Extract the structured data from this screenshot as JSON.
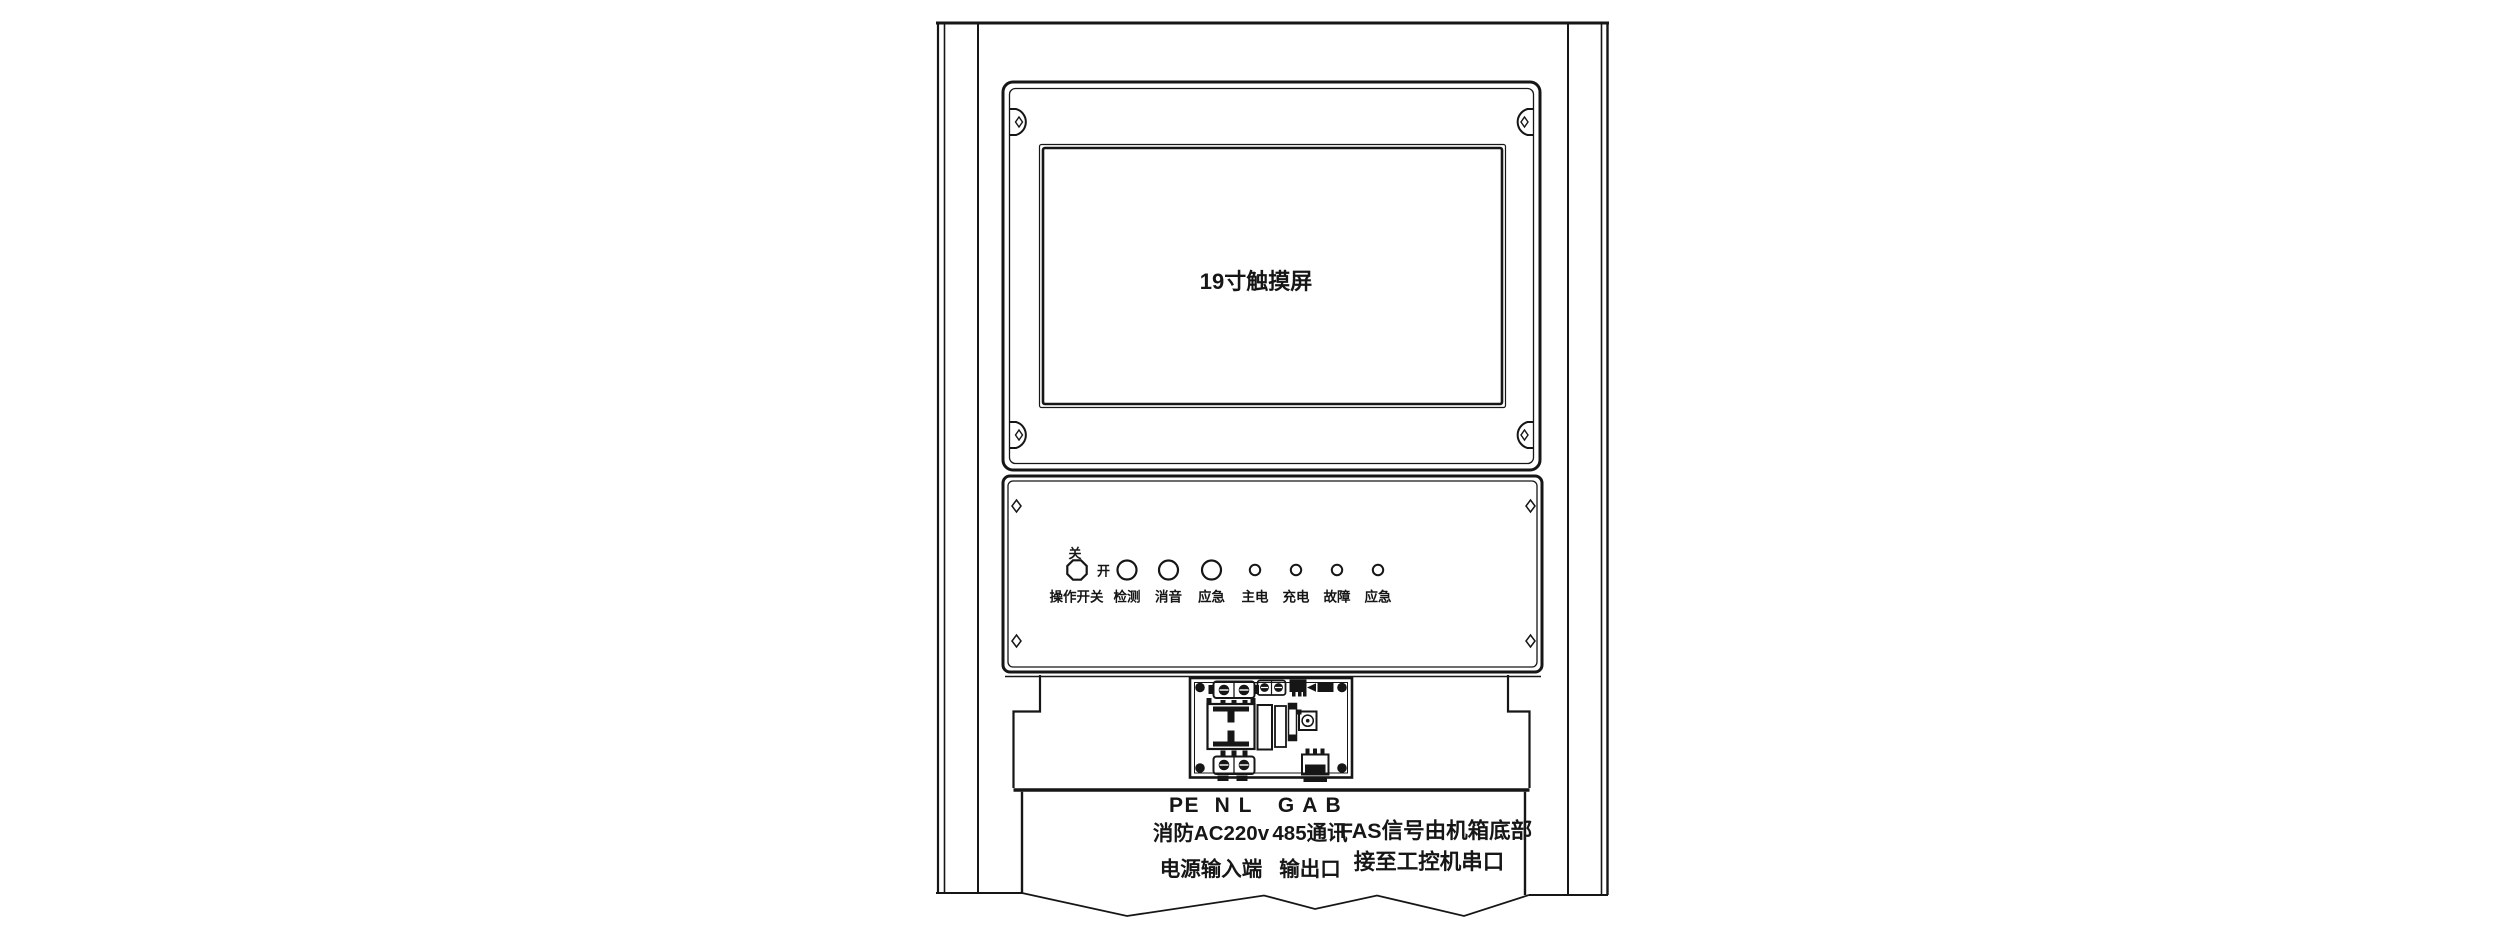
{
  "diagram": {
    "screen_label": "19寸触摸屏",
    "panel": {
      "switch_off": "关",
      "switch_on": "开",
      "switch_label": "操作开关",
      "buttons": [
        {
          "label": "检测"
        },
        {
          "label": "消音"
        },
        {
          "label": "应急"
        }
      ],
      "leds": [
        {
          "label": "主电"
        },
        {
          "label": "充电"
        },
        {
          "label": "故障"
        },
        {
          "label": "应急"
        }
      ]
    },
    "terminals": {
      "power_pins": "PE  N L",
      "power_line1": "消防AC220v",
      "power_line2": "电源输入端",
      "comm_pins": "G A B",
      "comm_line1": "485通讯",
      "comm_line2": "输出口",
      "fas_line1": "FAS信号由机箱底部",
      "fas_line2": "接至工控机串口"
    },
    "colors": {
      "ink": "#161616",
      "background": "#ffffff"
    }
  }
}
